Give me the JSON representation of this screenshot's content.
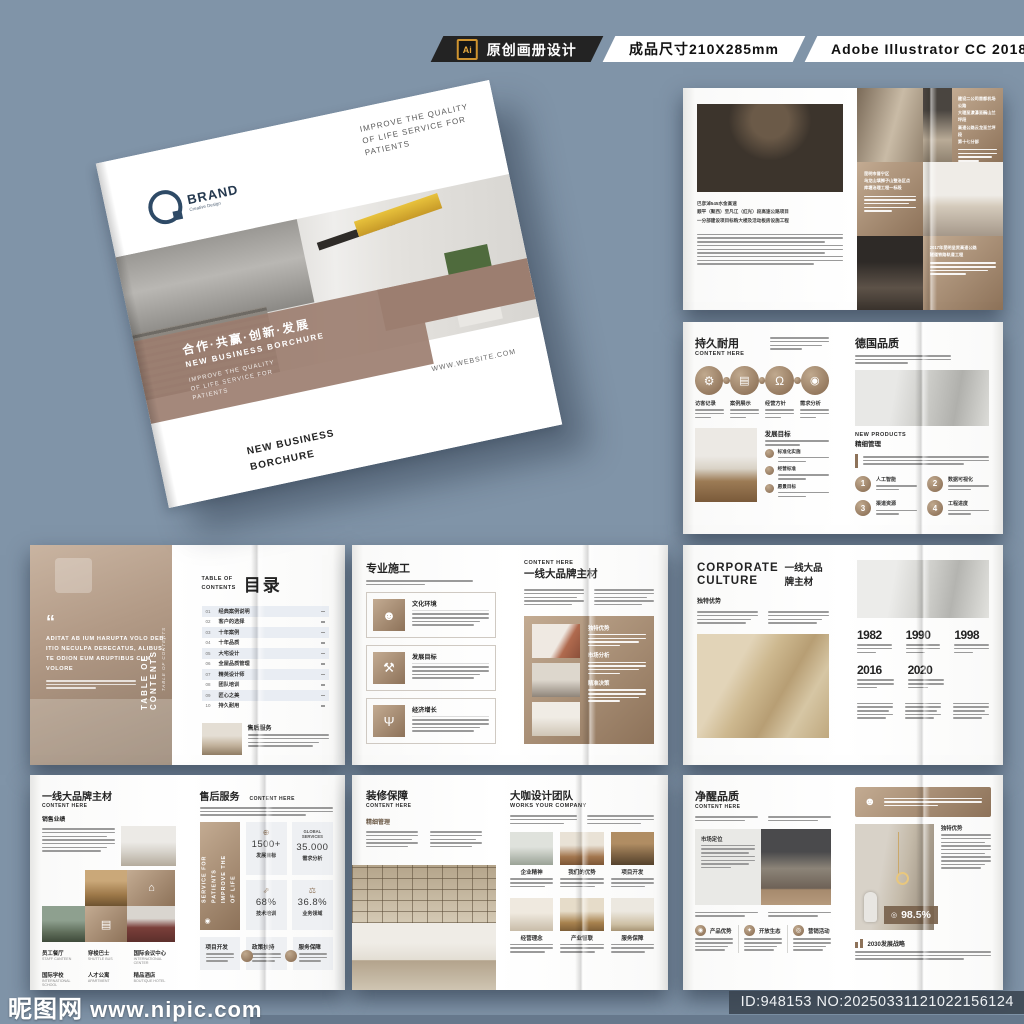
{
  "header": {
    "ai_badge": "Ai",
    "product_label": "原创画册设计",
    "size_label": "成品尺寸210X285mm",
    "software_label": "Adobe Illustrator CC 2018"
  },
  "cover": {
    "brand": "BRAND",
    "brand_sub": "Creative Design",
    "tagline": "IMPROVE THE QUALITY\nOF LIFE SERVICE FOR\nPATIENTS",
    "band_cn": "合作·共赢·创新·发展",
    "band_en": "NEW BUSINESS BORCHURE",
    "band_tagline": "IMPROVE THE QUALITY\nOF LIFE SERVICE FOR\nPATIENTS",
    "website": "WWW.WEBSITE.COM",
    "bottom_title": "NEW BUSINESS\nBORCHURE"
  },
  "spread_projects": {
    "caption": "巴彦淖545水金高速\n顺平（聚西）至凡江（红光）段高速公路项目\n一分部建设项目标购大楼及活动板房设施工程",
    "block1": "建设二公司首都机场公路\n大理至漾濞至巍山兰坪段\n高速公路云龙至兰坪段\n第十七分部",
    "block2": "昆明市晋宁区\n乌龙山填狮子山整治区点\n库塘治理工程一标段",
    "block3": "2017年昆明呈贡高速公路\n隧道铁路轨道工程"
  },
  "spread_durable": {
    "title": "持久耐用",
    "subtitle": "CONTENT HERE",
    "circles": [
      "访客记录",
      "案例展示",
      "经营方针",
      "需求分析"
    ],
    "goal_title": "发展目标",
    "goals": [
      "标准化实施",
      "经营标准",
      "愿景目标"
    ],
    "right_title": "德国品质",
    "new_products": "NEW PRODUCTS",
    "fine_mgmt": "精细管理",
    "numbered": [
      {
        "n": "1",
        "label": "人工智能"
      },
      {
        "n": "2",
        "label": "数据可视化"
      },
      {
        "n": "3",
        "label": "渠道资源"
      },
      {
        "n": "4",
        "label": "工程进度"
      }
    ]
  },
  "spread_toc": {
    "quote": "ADITAT AB IUM HARUPTA VOLO DEB-\nITIO NECULPA DERECATUS, ALIBUS,\nTE ODION EUM ARUPTIBUS CUM\nVOLORE",
    "quote_mark": "“",
    "vertical_title": "TABLE OF CONTENTS",
    "vertical_sub": "TABLE OF CONTENTS",
    "toc_label": "TABLE OF\nCONTENTS",
    "toc_title": "目录",
    "items": [
      {
        "no": "01",
        "label": "经典案例说明"
      },
      {
        "no": "02",
        "label": "客户的选择"
      },
      {
        "no": "03",
        "label": "十年案例"
      },
      {
        "no": "04",
        "label": "十年品质"
      },
      {
        "no": "05",
        "label": "大宅设计"
      },
      {
        "no": "06",
        "label": "全屋品质管理"
      },
      {
        "no": "07",
        "label": "精英设计师"
      },
      {
        "no": "08",
        "label": "团队培训"
      },
      {
        "no": "09",
        "label": "匠心之美"
      },
      {
        "no": "10",
        "label": "持久耐用"
      }
    ],
    "footer_title": "售后服务"
  },
  "spread_construction": {
    "title": "专业施工",
    "boxes": [
      {
        "title": "文化环境"
      },
      {
        "title": "发展目标"
      },
      {
        "title": "经济增长"
      }
    ],
    "right_label": "CONTENT HERE",
    "right_title": "一线大品牌主材",
    "panel_items": [
      "独特优势",
      "市场分析",
      "精准决策"
    ]
  },
  "spread_culture": {
    "title_en": "CORPORATE\nCULTURE",
    "title_cn": "一线大品牌主材",
    "subhead": "独特优势",
    "years": [
      "1982",
      "1990",
      "1998",
      "2016",
      "2020"
    ]
  },
  "spread_brand": {
    "title": "一线大品牌主材",
    "subtitle": "CONTENT HERE",
    "subhead": "销售业绩",
    "facilities": [
      {
        "cn": "员工餐厅",
        "en": "STAFF CANTEEN"
      },
      {
        "cn": "穿梭巴士",
        "en": "SHUTTLE BUS"
      },
      {
        "cn": "国际会议中心",
        "en": "INTERNATIONAL CENTER"
      },
      {
        "cn": "国际学校",
        "en": "INTERNATIONAL SCHOOL"
      },
      {
        "cn": "人才公寓",
        "en": "APARTMENT"
      },
      {
        "cn": "精品酒店",
        "en": "BOUTIQUE HOTEL"
      }
    ]
  },
  "spread_service": {
    "title": "售后服务",
    "subtitle": "CONTENT HERE",
    "vertical_text": "SERVICE FOR PATIENTS\nIMPROVE THE OF LIFE",
    "stats": [
      {
        "value": "1500+",
        "label": "发展目标"
      },
      {
        "head": "GLOBAL\nSERVICES",
        "value": "35.000",
        "label": "需求分析"
      },
      {
        "value": "68%",
        "label": "技术培训"
      },
      {
        "value": "36.8%",
        "label": "业务领域"
      }
    ],
    "features": [
      "项目开发",
      "政策扶持",
      "服务保障"
    ]
  },
  "spread_guarantee": {
    "title": "装修保障",
    "subtitle": "CONTENT HERE",
    "subhead": "精细管理",
    "right_title": "大咖设计团队",
    "right_subtitle": "WORKS YOUR COMPANY",
    "cards": [
      "企业精神",
      "我们的优势",
      "项目开发",
      "经营理念",
      "产业智联",
      "服务保障"
    ]
  },
  "spread_quality": {
    "title": "净醒品质",
    "subtitle": "CONTENT HERE",
    "panel_label": "市场定位",
    "features": [
      "产品优势",
      "开放生态",
      "营销活动"
    ],
    "right_subhead": "独特优势",
    "badge_value": "98.5%",
    "strategy": "2030发展战略"
  },
  "watermark": {
    "site": "昵图网",
    "url": "www.nipic.com",
    "id_no": "ID:948153 NO:20250331121022156124"
  }
}
